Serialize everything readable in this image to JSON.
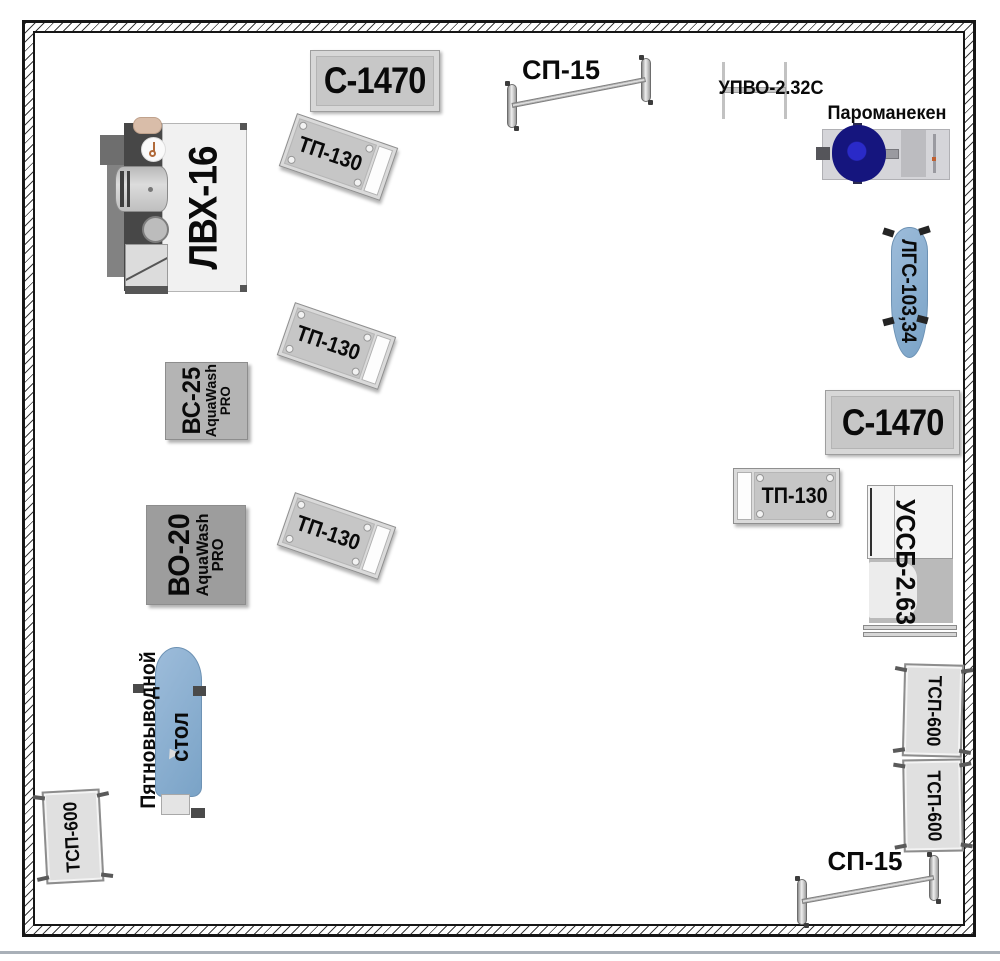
{
  "floor_plan": {
    "colors": {
      "wall_line": "#161616",
      "sign_bg": "#c7c7c7",
      "table_bg": "#e0e0e0",
      "machine_light_gray": "#b4b4b4",
      "machine_dark_gray": "#9d9d9d",
      "board_blue": "#85abce",
      "mannequin_navy": "#15157e",
      "mannequin_blue_center": "#2a2ac8"
    },
    "equipment": {
      "c1470_top": {
        "label": "С-1470"
      },
      "tp130_top": {
        "label": "ТП-130"
      },
      "sp15_top": {
        "label": "СП-15"
      },
      "upvo": {
        "label": "УПВО-2.32С"
      },
      "paromaneken": {
        "label": "Пароманекен"
      },
      "lvh16": {
        "label": "ЛВХ-16"
      },
      "tp130_mid": {
        "label": "ТП-130"
      },
      "vs25": {
        "model": "ВС-25",
        "brand": "AquaWash",
        "series": "PRO"
      },
      "tp130_low": {
        "label": "ТП-130"
      },
      "vo20": {
        "model": "ВО-20",
        "brand": "AquaWash",
        "series": "PRO"
      },
      "spot_table": {
        "label_line1": "Пятновыводной",
        "label_line2": "стол"
      },
      "tsp600_left": {
        "label": "ТСП-600"
      },
      "lgs": {
        "label": "ЛГС-103,34"
      },
      "c1470_right": {
        "label": "С-1470"
      },
      "tp130_right": {
        "label": "ТП-130"
      },
      "ussb": {
        "label": "УССБ-2.63"
      },
      "tsp600_right_1": {
        "label": "ТСП-600"
      },
      "tsp600_right_2": {
        "label": "ТСП-600"
      },
      "sp15_bottom": {
        "label": "СП-15"
      }
    }
  }
}
